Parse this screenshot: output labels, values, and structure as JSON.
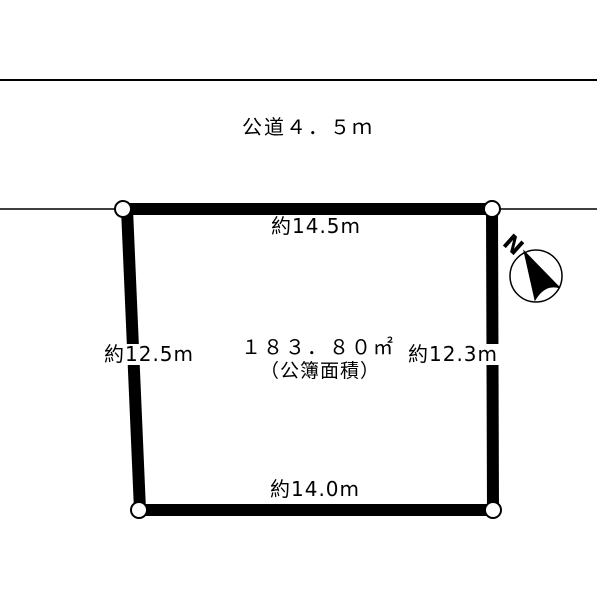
{
  "page": {
    "background": "#ffffff",
    "line_color": "#000000"
  },
  "road": {
    "label": "公道４．５ｍ"
  },
  "plot": {
    "area_value": "１８３．８０㎡",
    "area_note": "（公簿面積）",
    "dim_top": "約14.5m",
    "dim_left": "約12.5m",
    "dim_right": "約12.3m",
    "dim_bottom": "約14.0m"
  },
  "compass": {
    "label": "N"
  }
}
